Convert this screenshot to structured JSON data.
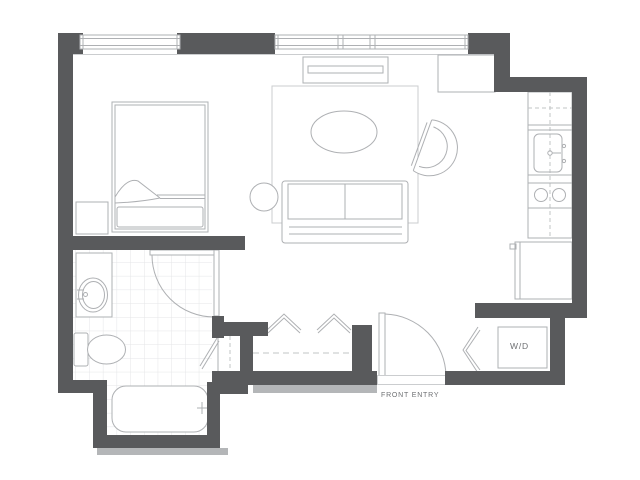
{
  "labels": {
    "front_entry": "FRONT ENTRY",
    "washer_dryer": "W/D"
  },
  "palette": {
    "wall": "#595a5c",
    "wall_light": "#b4b6b8",
    "line": "#aeb0b3",
    "line_light": "#cbcdcf",
    "tile": "#e4e5e7",
    "dash": "#c2c4c6",
    "text": "#6e7073",
    "background": "#ffffff"
  },
  "rooms": {
    "bedroom": [
      "bed",
      "blanket-fold",
      "pillow",
      "nightstand",
      "window"
    ],
    "living_room": [
      "rug",
      "sofa",
      "coffee-table",
      "side-table",
      "lounge-chair",
      "tv-console",
      "window",
      "corner-closet"
    ],
    "kitchen": [
      "counter",
      "upper-cabinet",
      "sink",
      "faucet",
      "stove-burners",
      "refrigerator"
    ],
    "bathroom": [
      "tile-floor",
      "vanity-sink",
      "toilet",
      "bathtub",
      "tub-faucet",
      "bath-door",
      "linen-closet"
    ],
    "entry": [
      "front-door",
      "door-swing",
      "threshold",
      "bifold-closet-doors",
      "closet-rod",
      "wd-closet-door",
      "washer-dryer"
    ]
  }
}
